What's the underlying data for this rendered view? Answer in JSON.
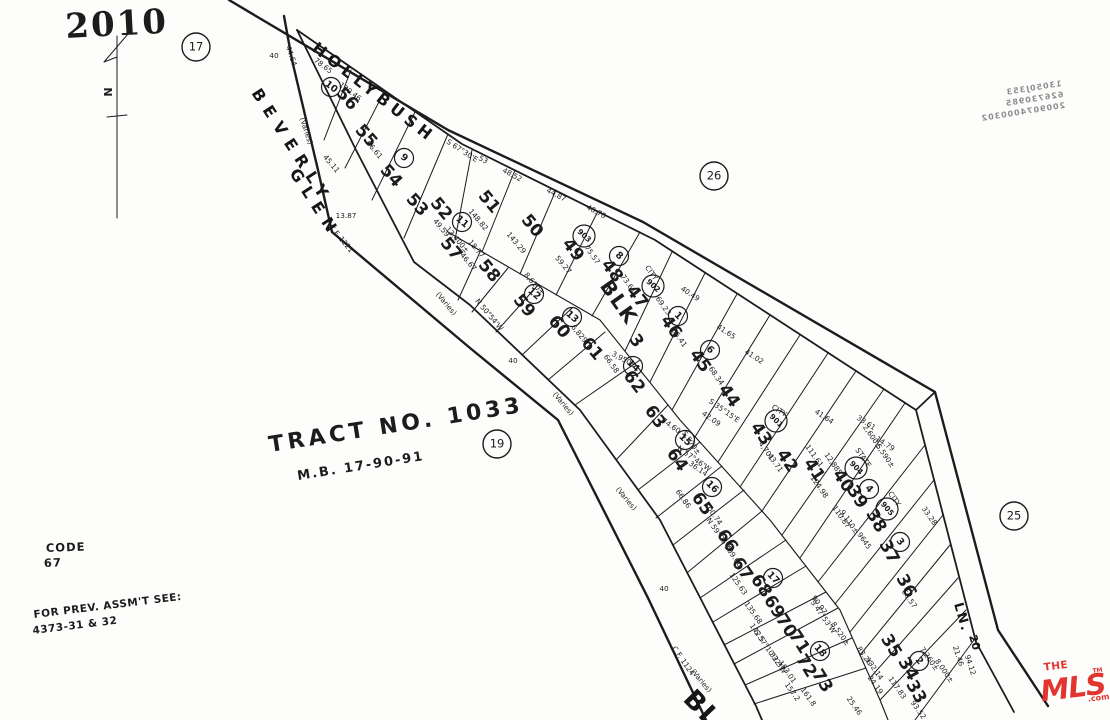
{
  "page": {
    "number": "2010",
    "code_label": "CODE",
    "code_value": "67",
    "prev_assmt_line1": "FOR PREV. ASSM'T SEE:",
    "prev_assmt_line2": "4373-31 & 32",
    "north_label": "N"
  },
  "tract": {
    "title": "TRACT NO. 1033",
    "map_book": "M.B. 17-90-91"
  },
  "block": {
    "label": "BLK",
    "number": "3",
    "x": 618,
    "y": 303,
    "r": 55,
    "nx": 636,
    "ny": 341
  },
  "streets": [
    {
      "name": "HOLLYBUSH",
      "x": 311,
      "y": 50,
      "r": 38,
      "s": 16,
      "sp": 5
    },
    {
      "name": "BEVERLY",
      "x": 251,
      "y": 93,
      "r": 57,
      "s": 16,
      "sp": 8
    },
    {
      "name": "GLEN",
      "x": 289,
      "y": 173,
      "r": 57,
      "s": 16,
      "sp": 8
    },
    {
      "name": "LN.",
      "x": 954,
      "y": 604,
      "r": 74,
      "s": 13,
      "sp": 2
    },
    {
      "name": "20",
      "x": 969,
      "y": 636,
      "r": 74,
      "s": 11,
      "sp": 0
    },
    {
      "name": "BL",
      "x": 682,
      "y": 700,
      "r": 46,
      "s": 26,
      "sp": 2
    }
  ],
  "page_refs": [
    {
      "v": "17",
      "x": 196,
      "y": 47
    },
    {
      "v": "26",
      "x": 714,
      "y": 176
    },
    {
      "v": "19",
      "x": 497,
      "y": 444
    },
    {
      "v": "25",
      "x": 1014,
      "y": 516
    }
  ],
  "lots": [
    {
      "n": "56",
      "x": 347,
      "y": 99,
      "r": 48,
      "c": "10",
      "cx": 331,
      "cy": 87
    },
    {
      "n": "55",
      "x": 366,
      "y": 136,
      "r": 48
    },
    {
      "n": "54",
      "x": 391,
      "y": 176,
      "r": 48,
      "c": "9",
      "cx": 404,
      "cy": 158
    },
    {
      "n": "53",
      "x": 417,
      "y": 205,
      "r": 48
    },
    {
      "n": "52",
      "x": 441,
      "y": 209,
      "r": 50
    },
    {
      "n": "51",
      "x": 489,
      "y": 202,
      "r": 50
    },
    {
      "n": "50",
      "x": 532,
      "y": 226,
      "r": 50
    },
    {
      "n": "49",
      "x": 573,
      "y": 250,
      "r": 52,
      "c": "903",
      "cx": 584,
      "cy": 236
    },
    {
      "n": "48",
      "x": 612,
      "y": 271,
      "r": 52,
      "c": "8",
      "cx": 619,
      "cy": 256
    },
    {
      "n": "47",
      "x": 637,
      "y": 297,
      "r": 52,
      "c": "902",
      "cx": 653,
      "cy": 286
    },
    {
      "n": "46",
      "x": 671,
      "y": 327,
      "r": 55,
      "c": "1",
      "cx": 678,
      "cy": 316
    },
    {
      "n": "45",
      "x": 700,
      "y": 361,
      "r": 55,
      "c": "6",
      "cx": 710,
      "cy": 350
    },
    {
      "n": "44",
      "x": 729,
      "y": 396,
      "r": 55
    },
    {
      "n": "43",
      "x": 761,
      "y": 434,
      "r": 55,
      "c": "901",
      "cx": 776,
      "cy": 421
    },
    {
      "n": "42",
      "x": 787,
      "y": 461,
      "r": 56
    },
    {
      "n": "41",
      "x": 814,
      "y": 470,
      "r": 56
    },
    {
      "n": "40",
      "x": 843,
      "y": 481,
      "r": 56,
      "c": "904",
      "cx": 856,
      "cy": 468
    },
    {
      "n": "39",
      "x": 857,
      "y": 497,
      "r": 58,
      "c": "4",
      "cx": 869,
      "cy": 489
    },
    {
      "n": "38",
      "x": 876,
      "y": 521,
      "r": 60,
      "c": "905",
      "cx": 887,
      "cy": 509
    },
    {
      "n": "37",
      "x": 889,
      "y": 552,
      "r": 62,
      "c": "3",
      "cx": 900,
      "cy": 542
    },
    {
      "n": "36",
      "x": 906,
      "y": 586,
      "r": 62
    },
    {
      "n": "35",
      "x": 891,
      "y": 646,
      "r": 58
    },
    {
      "n": "34",
      "x": 908,
      "y": 669,
      "r": 60,
      "c": "2",
      "cx": 919,
      "cy": 661
    },
    {
      "n": "33",
      "x": 916,
      "y": 692,
      "r": 60
    },
    {
      "n": "57",
      "x": 451,
      "y": 249,
      "r": 50,
      "c": "11",
      "cx": 462,
      "cy": 222
    },
    {
      "n": "58",
      "x": 489,
      "y": 271,
      "r": 50
    },
    {
      "n": "59",
      "x": 524,
      "y": 306,
      "r": 50,
      "c": "12",
      "cx": 534,
      "cy": 294
    },
    {
      "n": "60",
      "x": 559,
      "y": 327,
      "r": 50,
      "c": "13",
      "cx": 572,
      "cy": 317
    },
    {
      "n": "61",
      "x": 592,
      "y": 349,
      "r": 50
    },
    {
      "n": "62",
      "x": 634,
      "y": 382,
      "r": 52,
      "c": "14",
      "cx": 633,
      "cy": 366
    },
    {
      "n": "63",
      "x": 655,
      "y": 417,
      "r": 55
    },
    {
      "n": "64",
      "x": 677,
      "y": 460,
      "r": 55,
      "c": "15",
      "cx": 685,
      "cy": 440
    },
    {
      "n": "65",
      "x": 702,
      "y": 504,
      "r": 55,
      "c": "16",
      "cx": 712,
      "cy": 487
    },
    {
      "n": "66",
      "x": 727,
      "y": 541,
      "r": 56
    },
    {
      "n": "67",
      "x": 742,
      "y": 569,
      "r": 56
    },
    {
      "n": "68",
      "x": 761,
      "y": 586,
      "r": 56,
      "c": "17",
      "cx": 773,
      "cy": 578
    },
    {
      "n": "69",
      "x": 774,
      "y": 607,
      "r": 57
    },
    {
      "n": "70",
      "x": 786,
      "y": 626,
      "r": 57
    },
    {
      "n": "71",
      "x": 799,
      "y": 642,
      "r": 57
    },
    {
      "n": "72",
      "x": 806,
      "y": 666,
      "r": 58,
      "c": "18",
      "cx": 820,
      "cy": 651
    },
    {
      "n": "73",
      "x": 822,
      "y": 681,
      "r": 58
    }
  ],
  "annotations": [
    {
      "t": "S 67°30'E",
      "x": 462,
      "y": 151,
      "r": 33
    },
    {
      "t": "48.52",
      "x": 512,
      "y": 175,
      "r": 28
    },
    {
      "t": "44.87",
      "x": 556,
      "y": 195,
      "r": 28
    },
    {
      "t": "40.70",
      "x": 596,
      "y": 212,
      "r": 28
    },
    {
      "t": "53",
      "x": 483,
      "y": 160,
      "r": 28
    },
    {
      "t": "78.65",
      "x": 323,
      "y": 66,
      "r": 37
    },
    {
      "t": "130.46",
      "x": 350,
      "y": 92,
      "r": 37
    },
    {
      "t": "44.64",
      "x": 291,
      "y": 56,
      "r": 72
    },
    {
      "t": "40.49",
      "x": 690,
      "y": 294,
      "r": 33
    },
    {
      "t": "41.65",
      "x": 726,
      "y": 332,
      "r": 33
    },
    {
      "t": "41.02",
      "x": 754,
      "y": 357,
      "r": 33
    },
    {
      "t": "41.64",
      "x": 824,
      "y": 417,
      "r": 33
    },
    {
      "t": "33.61",
      "x": 866,
      "y": 423,
      "r": 33
    },
    {
      "t": "14.79",
      "x": 885,
      "y": 444,
      "r": 33
    },
    {
      "t": "66.61",
      "x": 374,
      "y": 150,
      "r": 50
    },
    {
      "t": "45.11",
      "x": 331,
      "y": 164,
      "r": 50
    },
    {
      "t": "49.59",
      "x": 441,
      "y": 228,
      "r": 50
    },
    {
      "t": "13,400±",
      "x": 457,
      "y": 240,
      "r": 50
    },
    {
      "t": "148.82",
      "x": 478,
      "y": 220,
      "r": 50
    },
    {
      "t": "143.29",
      "x": 516,
      "y": 243,
      "r": 50
    },
    {
      "t": "59.27",
      "x": 563,
      "y": 265,
      "r": 50
    },
    {
      "t": "75.57",
      "x": 592,
      "y": 255,
      "r": 55
    },
    {
      "t": "73.61",
      "x": 628,
      "y": 284,
      "r": 55
    },
    {
      "t": "69.23",
      "x": 663,
      "y": 306,
      "r": 55
    },
    {
      "t": "65.41",
      "x": 679,
      "y": 338,
      "r": 55
    },
    {
      "t": "68.34",
      "x": 716,
      "y": 376,
      "r": 55
    },
    {
      "t": "18.77",
      "x": 476,
      "y": 249,
      "r": 50
    },
    {
      "t": "46.67",
      "x": 468,
      "y": 262,
      "r": 50
    },
    {
      "t": "N 50°54'W",
      "x": 489,
      "y": 315,
      "r": 50
    },
    {
      "t": "8,610±",
      "x": 534,
      "y": 284,
      "r": 50
    },
    {
      "t": "6,829",
      "x": 579,
      "y": 334,
      "r": 50
    },
    {
      "t": "3,950±",
      "x": 624,
      "y": 360,
      "r": 28
    },
    {
      "t": "66.58",
      "x": 611,
      "y": 364,
      "r": 55
    },
    {
      "t": "CITY",
      "x": 651,
      "y": 273,
      "r": 55
    },
    {
      "t": "5,570±",
      "x": 691,
      "y": 443,
      "r": 55
    },
    {
      "t": "74.60",
      "x": 671,
      "y": 426,
      "r": 35
    },
    {
      "t": "42.09",
      "x": 711,
      "y": 419,
      "r": 35
    },
    {
      "t": "S 35°15'E",
      "x": 724,
      "y": 411,
      "r": 35
    },
    {
      "t": "N 57°46'W",
      "x": 694,
      "y": 459,
      "r": 35
    },
    {
      "t": "36.14",
      "x": 698,
      "y": 469,
      "r": 35
    },
    {
      "t": "4,701",
      "x": 766,
      "y": 451,
      "r": 55
    },
    {
      "t": "43.71",
      "x": 775,
      "y": 463,
      "r": 55
    },
    {
      "t": "CITY",
      "x": 779,
      "y": 411,
      "r": 33
    },
    {
      "t": "STATE",
      "x": 863,
      "y": 458,
      "r": 55
    },
    {
      "t": "2,600±",
      "x": 872,
      "y": 437,
      "r": 55
    },
    {
      "t": "5,590±",
      "x": 885,
      "y": 456,
      "r": 55
    },
    {
      "t": "111.61",
      "x": 814,
      "y": 456,
      "r": 55
    },
    {
      "t": "12,885",
      "x": 833,
      "y": 464,
      "r": 55
    },
    {
      "t": "124.98",
      "x": 819,
      "y": 487,
      "r": 55
    },
    {
      "t": "110.87",
      "x": 841,
      "y": 517,
      "r": 55
    },
    {
      "t": "9,110±",
      "x": 849,
      "y": 522,
      "r": 55
    },
    {
      "t": "9645",
      "x": 864,
      "y": 541,
      "r": 55
    },
    {
      "t": "CITY",
      "x": 894,
      "y": 499,
      "r": 55
    },
    {
      "t": "33.28",
      "x": 929,
      "y": 516,
      "r": 55
    },
    {
      "t": "66.57",
      "x": 909,
      "y": 599,
      "r": 55
    },
    {
      "t": "100.74",
      "x": 713,
      "y": 514,
      "r": 55
    },
    {
      "t": "N 59°06'W",
      "x": 719,
      "y": 535,
      "r": 55
    },
    {
      "t": "66.86",
      "x": 683,
      "y": 499,
      "r": 55
    },
    {
      "t": "109.66",
      "x": 733,
      "y": 556,
      "r": 55
    },
    {
      "t": "125.63",
      "x": 738,
      "y": 584,
      "r": 55
    },
    {
      "t": "135.68",
      "x": 753,
      "y": 613,
      "r": 55
    },
    {
      "t": "142.5",
      "x": 757,
      "y": 633,
      "r": 55
    },
    {
      "t": "90.97",
      "x": 819,
      "y": 605,
      "r": 55
    },
    {
      "t": "S 47°53'W",
      "x": 823,
      "y": 617,
      "r": 55
    },
    {
      "t": "8,520±",
      "x": 840,
      "y": 634,
      "r": 55
    },
    {
      "t": "S 57°10'32\"W",
      "x": 770,
      "y": 652,
      "r": 55
    },
    {
      "t": "32.31",
      "x": 777,
      "y": 662,
      "r": 55
    },
    {
      "t": "153.01",
      "x": 787,
      "y": 672,
      "r": 55
    },
    {
      "t": "157.2",
      "x": 792,
      "y": 692,
      "r": 55
    },
    {
      "t": "161.8",
      "x": 808,
      "y": 697,
      "r": 55
    },
    {
      "t": "83.26",
      "x": 864,
      "y": 656,
      "r": 55
    },
    {
      "t": "132.14",
      "x": 874,
      "y": 669,
      "r": 55
    },
    {
      "t": "24.19",
      "x": 875,
      "y": 685,
      "r": 55
    },
    {
      "t": "117.83",
      "x": 897,
      "y": 688,
      "r": 55
    },
    {
      "t": "93.52",
      "x": 918,
      "y": 710,
      "r": 55
    },
    {
      "t": "25.46",
      "x": 854,
      "y": 706,
      "r": 55
    },
    {
      "t": "7,260±",
      "x": 929,
      "y": 659,
      "r": 55
    },
    {
      "t": "8,000±",
      "x": 944,
      "y": 671,
      "r": 55
    },
    {
      "t": "21.46",
      "x": 958,
      "y": 656,
      "r": 72
    },
    {
      "t": "94.12",
      "x": 970,
      "y": 665,
      "r": 72
    },
    {
      "t": "(Varies)",
      "x": 306,
      "y": 131,
      "r": 72,
      "s": 7.8
    },
    {
      "t": "(Varies)",
      "x": 446,
      "y": 304,
      "r": 50,
      "s": 7.8
    },
    {
      "t": "(Varies)",
      "x": 563,
      "y": 404,
      "r": 50,
      "s": 7.8
    },
    {
      "t": "(Varies)",
      "x": 626,
      "y": 499,
      "r": 50,
      "s": 7.8
    },
    {
      "t": "(Varies)",
      "x": 701,
      "y": 681,
      "r": 50,
      "s": 7.8
    },
    {
      "t": "C.F. 1221",
      "x": 341,
      "y": 239,
      "r": 50,
      "s": 7.8
    },
    {
      "t": "C.F. 1124",
      "x": 683,
      "y": 661,
      "r": 55,
      "s": 7.8
    },
    {
      "t": "40",
      "x": 274,
      "y": 56,
      "r": 0,
      "s": 8
    },
    {
      "t": "40",
      "x": 513,
      "y": 361,
      "r": 0,
      "s": 8
    },
    {
      "t": "40",
      "x": 664,
      "y": 589,
      "r": 0,
      "s": 8
    },
    {
      "t": "13.87",
      "x": 346,
      "y": 216,
      "r": 0
    }
  ],
  "bleed_through": {
    "x": 1062,
    "y": 86,
    "r": -9,
    "lines": [
      "13050J353",
      "626730985",
      "2009074000302"
    ]
  },
  "logo": {
    "the": "THE",
    "mls": "MLS",
    "com": ".com",
    "tm": "TM",
    "color": "#e23530"
  }
}
